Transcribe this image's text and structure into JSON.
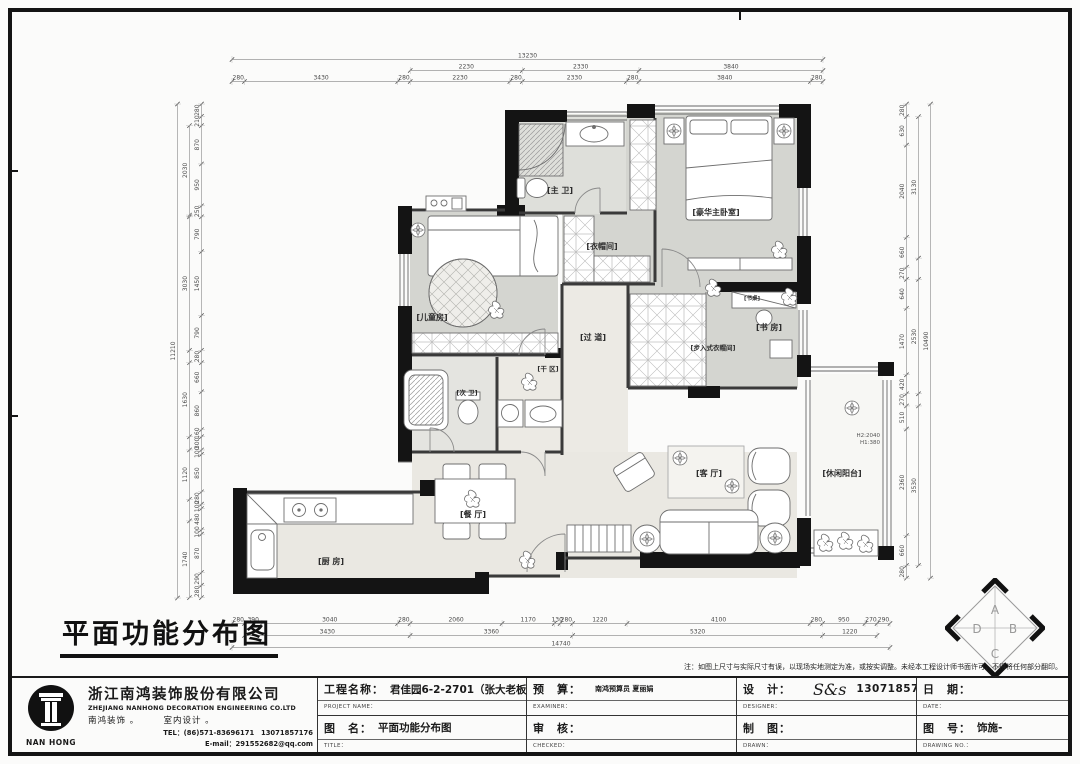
{
  "plan": {
    "big_title": "平面功能分布图",
    "rooms": [
      {
        "id": "master-bath",
        "label": "[主 卫]"
      },
      {
        "id": "cloakroom",
        "label": "[衣帽间]"
      },
      {
        "id": "master-bedroom",
        "label": "[豪华主卧室]"
      },
      {
        "id": "kids-room",
        "label": "[儿童房]"
      },
      {
        "id": "hallway",
        "label": "[过 道]"
      },
      {
        "id": "study",
        "label": "[书 房]"
      },
      {
        "id": "walkin-closet",
        "label": "[步入式衣帽间]"
      },
      {
        "id": "dry-area",
        "label": "[干 区]"
      },
      {
        "id": "second-bath",
        "label": "[次 卫]"
      },
      {
        "id": "kitchen",
        "label": "[厨 房]"
      },
      {
        "id": "dining",
        "label": "[餐 厅]"
      },
      {
        "id": "living",
        "label": "[客 厅]"
      },
      {
        "id": "balcony",
        "label": "[休闲阳台]"
      },
      {
        "id": "desk",
        "label": "[书桌]"
      }
    ],
    "annotations": {
      "h2": "H2:2040",
      "h1": "H1:380"
    },
    "compass": {
      "letters": [
        "A",
        "B",
        "C",
        "D"
      ]
    }
  },
  "dims": {
    "top": {
      "overall": "13230",
      "mid": [
        "2230",
        "2330",
        "3840"
      ],
      "inner": [
        "280",
        "3430",
        "280",
        "2230",
        "280",
        "2330",
        "280",
        "3840",
        "280"
      ]
    },
    "bottom": {
      "overall": "14740",
      "mid": [
        "3430",
        "3360",
        "5320",
        "1220"
      ],
      "inner": [
        "280",
        "390",
        "3040",
        "280",
        "2060",
        "1170",
        "130",
        "280",
        "1220",
        "4100",
        "280",
        "950",
        "270",
        "290"
      ]
    },
    "left": {
      "overall": "11210",
      "mid": [
        "2030",
        "3030",
        "1630",
        "1120",
        "1740"
      ],
      "inner": [
        "280",
        "210",
        "870",
        "950",
        "250",
        "790",
        "1450",
        "790",
        "280",
        "660",
        "860",
        "160",
        "300",
        "100",
        "850",
        "280",
        "100",
        "480",
        "100",
        "870",
        "290",
        "280"
      ]
    },
    "right": {
      "overall": "10490",
      "mid": [
        "3130",
        "2530",
        "3530"
      ],
      "inner": [
        "280",
        "630",
        "2040",
        "660",
        "270",
        "640",
        "1470",
        "420",
        "270",
        "510",
        "2360",
        "660",
        "280"
      ]
    }
  },
  "titleblock": {
    "note": "注：如图上尺寸与实际尺寸有误，以现场实地测定为准，或按实调整。未经本工程设计师书面许可，不得将任何部分翻印。",
    "company": {
      "logo_text": "NAN HONG",
      "name_cn": "浙江南鸿装饰股份有限公司",
      "name_en": "ZHEJIANG NANHONG DECORATION ENGINEERING CO.LTD",
      "subtitle": "南鸿装饰 。　　　室内设计 。",
      "tel": "TEL：(86)571-83696171　13071857176",
      "email": "E-mail：291552682@qq.com"
    },
    "cells": {
      "project": {
        "label": "工程名称：",
        "caption": "PROJECT NAME：",
        "value": "君佳园6-2-2701（张大老板娘）"
      },
      "budget": {
        "label": "预　算：",
        "caption": "EXAMINER：",
        "value": "南鸿预算员 夏丽娟"
      },
      "design": {
        "label": "设　计：",
        "caption": "DESIGNER：",
        "value_script": "S&s",
        "value_phone": "13071857176"
      },
      "date": {
        "label": "日　期：",
        "caption": "DATE：",
        "value": ""
      },
      "title": {
        "label": "图　名：",
        "caption": "TITLE：",
        "value": "平面功能分布图"
      },
      "check": {
        "label": "审　核：",
        "caption": "CHECKED：",
        "value": ""
      },
      "draw": {
        "label": "制　图：",
        "caption": "DRAWN：",
        "value": ""
      },
      "number": {
        "label": "图　号：",
        "caption": "DRAWING NO.：",
        "value": "饰施-"
      }
    }
  }
}
